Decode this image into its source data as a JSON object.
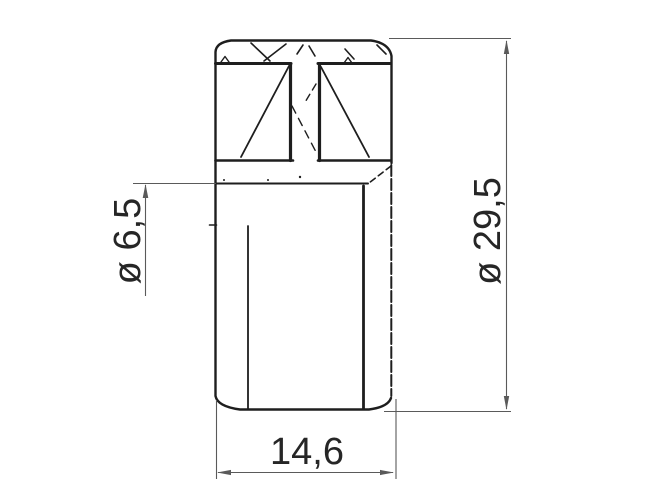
{
  "drawing": {
    "colors": {
      "background": "#ffffff",
      "part_line": "#1e1e1e",
      "dim_line": "#5a5a5a",
      "dim_text": "#262626"
    },
    "dimensions": {
      "bore_diameter": {
        "label": "ø 6,5"
      },
      "outer_diameter": {
        "label": "ø 29,5"
      },
      "length": {
        "label": "14,6"
      }
    }
  }
}
